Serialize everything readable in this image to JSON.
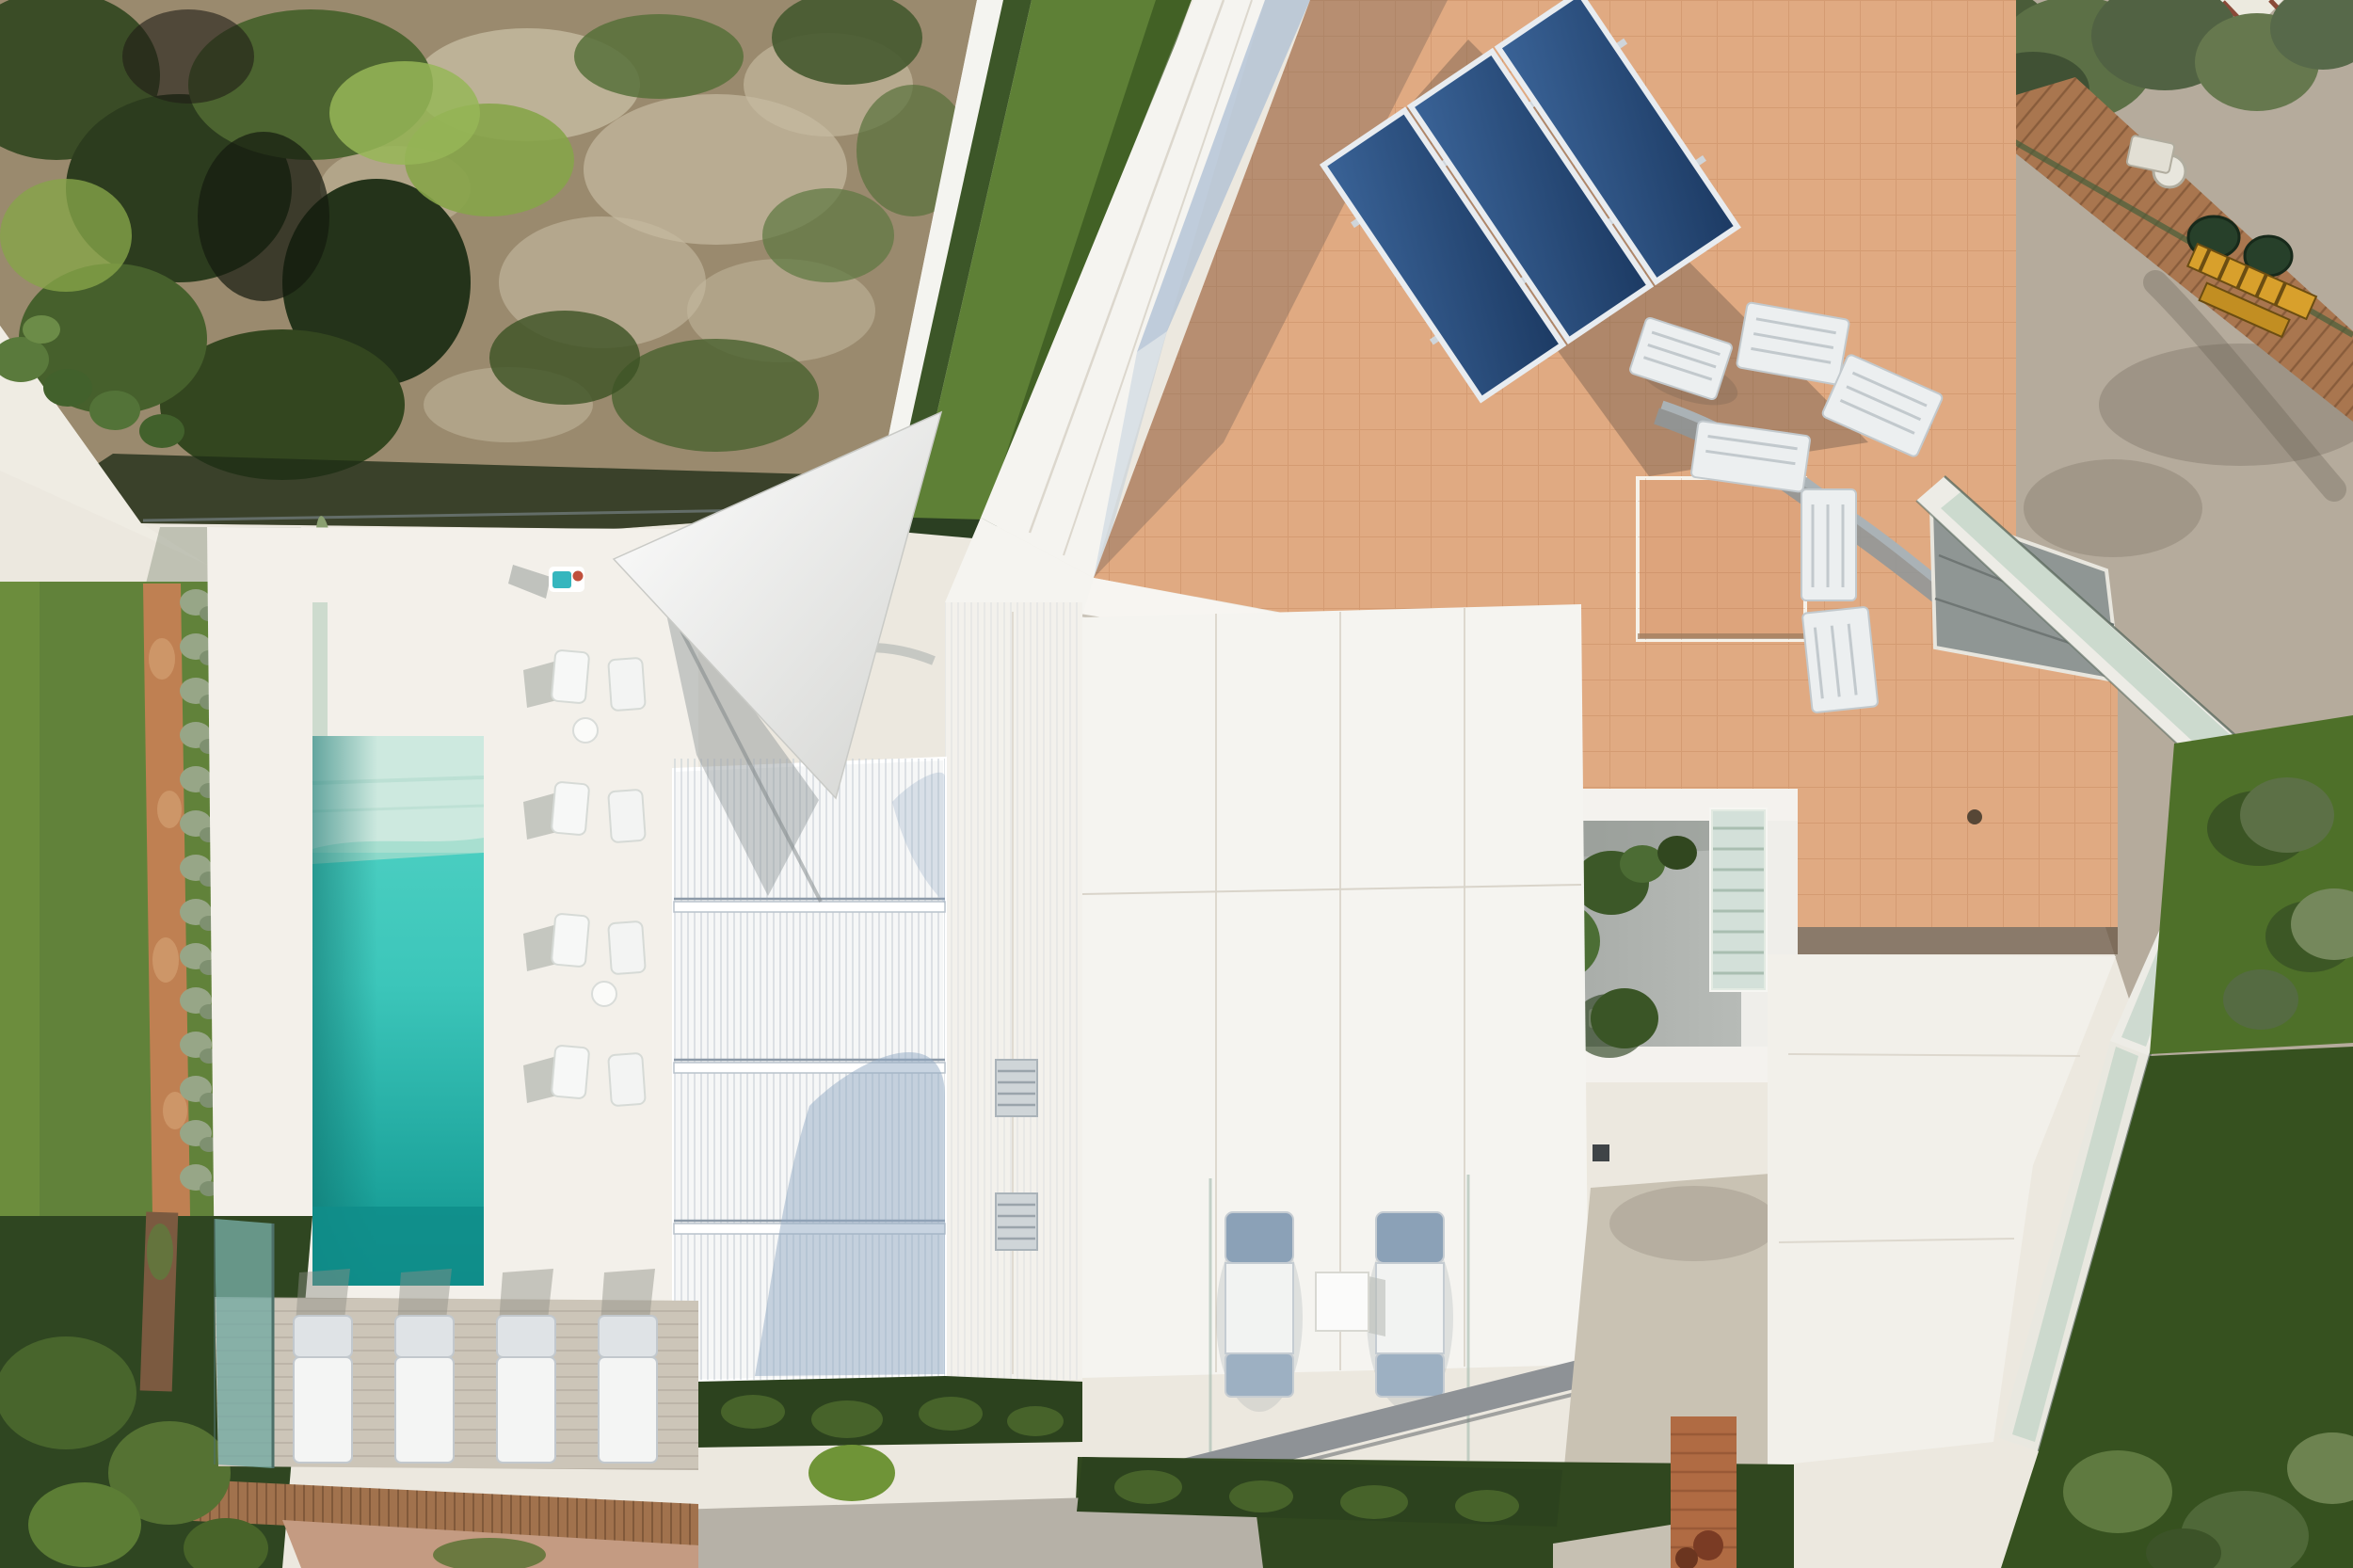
{
  "scene": {
    "type": "aerial-drone-photograph",
    "subject": "Top-down view of a modern white villa with rectangular turquoise pool, white pergola, terracotta tiled roof with solar panels and AC units, inner courtyard with trees, sun terraces with loungers, lawns, scrub hillside and neighbouring yard",
    "lighting": "hard midday sun with long crisp shadows"
  },
  "colors": {
    "baseTerrace": "#ece8df",
    "whiteRoof": "#f5f4f0",
    "brightWhite": "#fafaf7",
    "concrete": "#b5ab9c",
    "scrubDirt": "#9a8a6e",
    "scrubRock": "#c6bba1",
    "scrubGreenDark": "#384a24",
    "scrubGreenMid": "#57703a",
    "scrubGreenBright": "#86a449",
    "lawn": "#61823a",
    "lawnDark": "#2f4621",
    "grassStrip": "#5e8036",
    "grassPatch": "#4e7029",
    "gravelPath": "#bf8052",
    "hedgeSilver": "#97a687",
    "hedgeDark": "#2c421e",
    "poolShallow": "#cde9df",
    "poolLight": "#55d4c6",
    "poolMid": "#3cc6ba",
    "poolDeep": "#0f8d89",
    "glassTint": "#9fc0ae",
    "pergolaSlat": "#c3ccd4",
    "shadowBlue": "#aabdd3",
    "treeShadowBlue": "#92a9c4",
    "terracotta": "#e0aa82",
    "terracottaDark": "#6e5b49",
    "tileLine": "#a6643a",
    "panelBlue": "#2c5484",
    "panelBlueDark": "#1c3a63",
    "acWhite": "#eceff0",
    "ductSilver": "#aab2b6",
    "woodDeck": "#a9764f",
    "woodWall": "#a1724d",
    "brickPath": "#b06b43",
    "courtyardFloor": "#b7bbb7",
    "oliveTree": "#5c7046",
    "barrelGreen": "#27402a",
    "ladderYellow": "#d8a02c",
    "towelTeal": "#35b6be",
    "loungerCushion": "#8ba1b7"
  },
  "objects": {
    "swimming_pool": {
      "shape": "rectangle",
      "orientation": "vertical",
      "shallow_end": "top",
      "dark_end": "bottom"
    },
    "solar_panels": {
      "count": 3,
      "tilt_deg": -34,
      "surface": "terracotta roof"
    },
    "ac_units": {
      "count": 6,
      "location": "terracotta roof right of solar panels"
    },
    "chimney_block": {
      "count": 1
    },
    "pergola": {
      "beams": 3,
      "sections": 4,
      "finish": "white slats"
    },
    "shade_sail": {
      "count": 1,
      "shape": "triangle"
    },
    "poolside_loungers": {
      "count": 4,
      "location": "lower-left stone deck"
    },
    "poolside_chairs": {
      "count": 4,
      "location": "between pool and pergola"
    },
    "terrace_loungers": {
      "count": 2,
      "location": "bottom central terrace",
      "table": 1
    },
    "louvre_openings": {
      "count": 2,
      "location": "white wall column"
    },
    "courtyard_trees": {
      "count": 4,
      "location": "sunken inner courtyard"
    },
    "courtyard_skylight": {
      "count": 1,
      "finish": "green-tinted louvres"
    },
    "person_sunbathing": {
      "count": 1,
      "location": "upper pool terrace",
      "towel": "teal"
    },
    "green_barrels": {
      "count": 2,
      "location": "neighbour yard top-right"
    },
    "yellow_ladder": {
      "count": 1,
      "location": "neighbour yard top-right"
    },
    "hedge_bushes_path": {
      "count": 14,
      "location": "along gravel path on left lawn"
    },
    "glass_balustrades": {
      "count": 5,
      "finish": "frameless teal-tinted glass"
    },
    "wooden_retaining_wall": {
      "count": 1,
      "location": "below pool deck"
    },
    "neighbour_wood_deck": {
      "count": 1,
      "location": "top-right diagonal"
    }
  }
}
